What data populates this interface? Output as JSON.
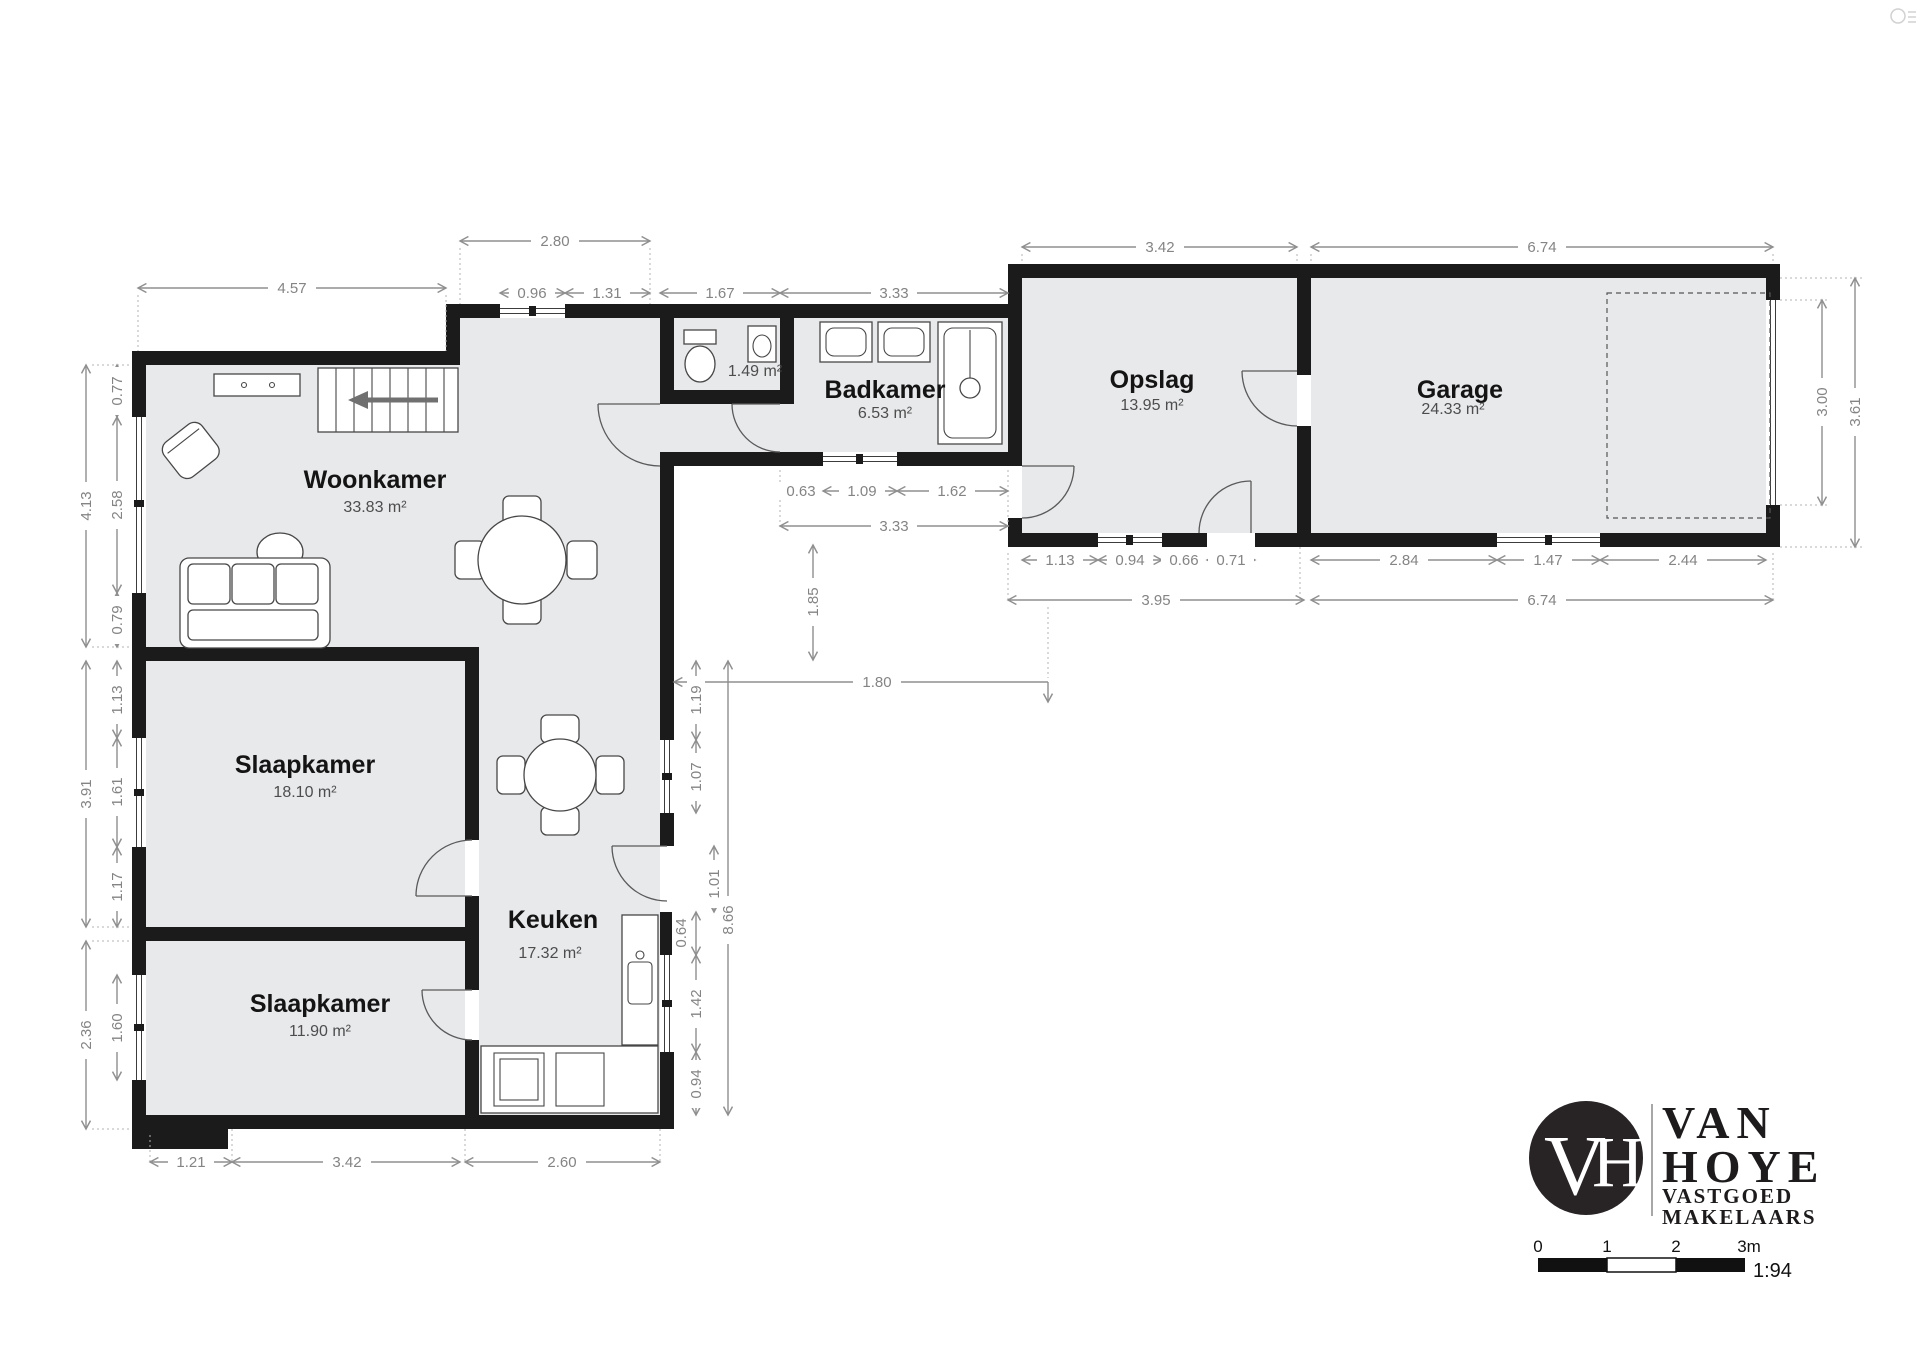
{
  "plan": {
    "rooms": [
      {
        "name": "Woonkamer",
        "area": "33.83 m²"
      },
      {
        "name": "Slaapkamer",
        "area": "18.10 m²"
      },
      {
        "name": "Slaapkamer",
        "area": "11.90 m²"
      },
      {
        "name": "Keuken",
        "area": "17.32 m²"
      },
      {
        "name": "Badkamer",
        "area": "6.53 m²"
      },
      {
        "name": "Opslag",
        "area": "13.95 m²"
      },
      {
        "name": "Garage",
        "area": "24.33 m²"
      },
      {
        "name": "",
        "area": "1.49 m²"
      }
    ],
    "dims": {
      "top": [
        "4.57",
        "2.80",
        "0.96",
        "1.31",
        "1.67",
        "3.33",
        "3.42",
        "6.74"
      ],
      "left": [
        "0.77",
        "2.58",
        "0.79",
        "4.13",
        "1.13",
        "1.61",
        "1.17",
        "3.91",
        "1.60",
        "2.36"
      ],
      "bottom": [
        "1.21",
        "3.42",
        "2.60"
      ],
      "inner": [
        "0.63",
        "1.09",
        "1.62",
        "3.33",
        "1.85",
        "1.80",
        "1.19",
        "1.07",
        "1.01",
        "8.66",
        "0.64",
        "1.42",
        "0.94"
      ],
      "wing": [
        "1.13",
        "0.94",
        "0.66",
        "0.71",
        "3.95",
        "2.84",
        "1.47",
        "2.44",
        "6.74"
      ],
      "right": [
        "3.00",
        "3.61"
      ]
    }
  },
  "branding": {
    "logo_initials": "VH",
    "name_line1": "VAN",
    "name_line2": "HOYE",
    "subtitle_line1": "VASTGOED",
    "subtitle_line2": "MAKELAARS"
  },
  "scalebar": {
    "ticks": [
      "0",
      "1",
      "2",
      "3m"
    ],
    "ratio": "1:94"
  },
  "colors": {
    "wall": "#1b1b1b",
    "floor": "#e8e9eb",
    "dimension": "#8f8f8f",
    "logo_dark": "#282425"
  }
}
